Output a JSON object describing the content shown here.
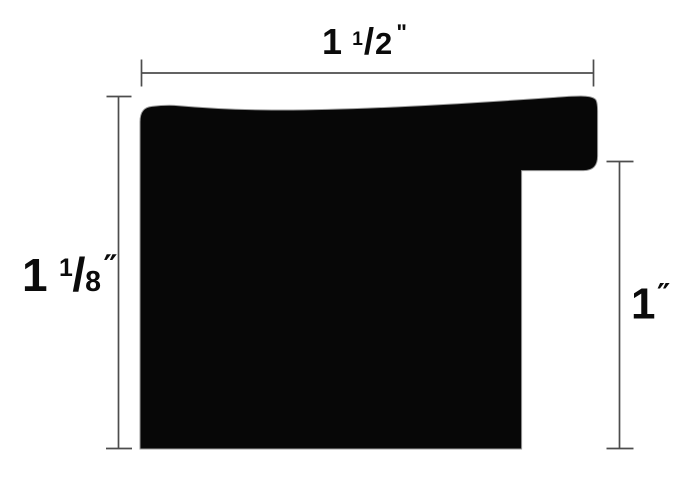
{
  "page": {
    "background": "#ffffff"
  },
  "diagram": {
    "name": "picture-frame-moulding-profile-cross-section",
    "colors": {
      "shape_fill": "#070707",
      "shape_outline": "#9b9b9b",
      "dimension_line": "#4d4d4d",
      "label_text": "#0b0b0b"
    },
    "dimensions": {
      "width": {
        "whole": "1",
        "frac_numerator": "1",
        "slash": "/",
        "frac_denominator": "2",
        "unit": "ʺ"
      },
      "height": {
        "whole": "1",
        "frac_numerator": "1",
        "slash": "/",
        "frac_denominator": "8",
        "unit": "″"
      },
      "rabbet_height": {
        "whole": "1",
        "unit": "″"
      }
    }
  }
}
